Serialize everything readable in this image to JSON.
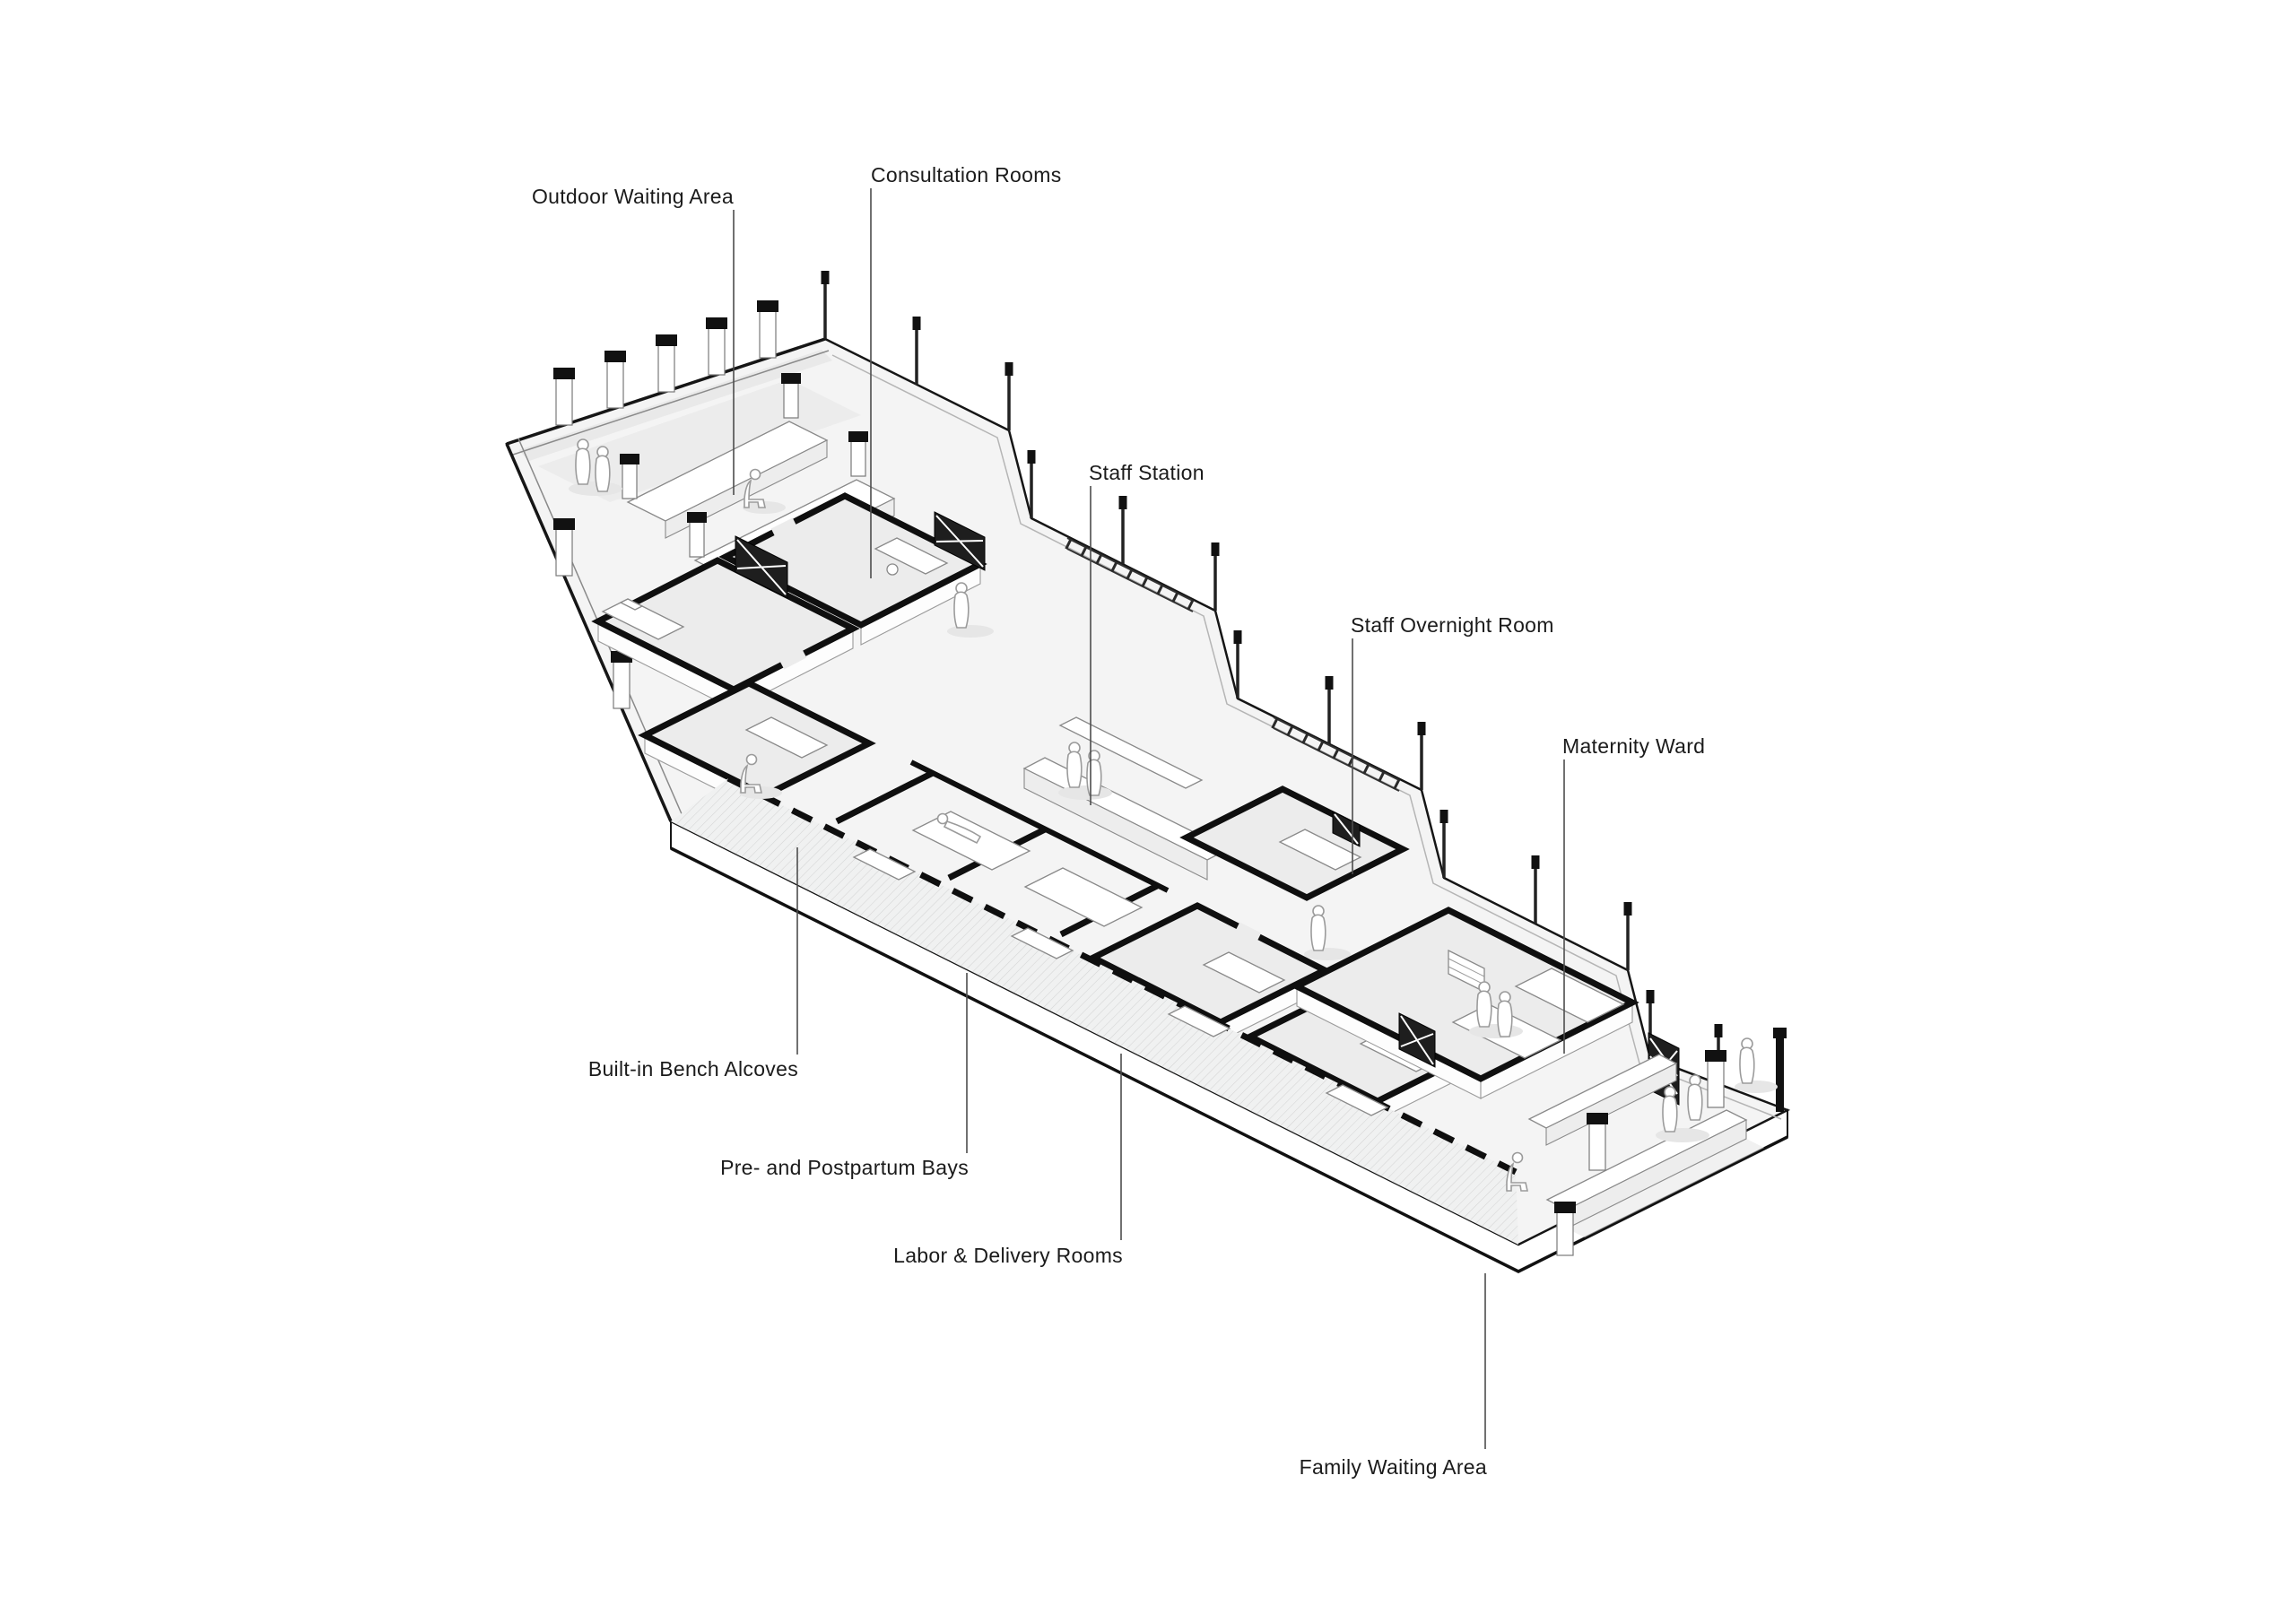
{
  "diagram": {
    "kind": "axonometric architectural floor-plan diagram",
    "annotations": [
      {
        "id": "outdoor-waiting-area",
        "label": "Outdoor Waiting Area"
      },
      {
        "id": "consultation-rooms",
        "label": "Consultation Rooms"
      },
      {
        "id": "staff-station",
        "label": "Staff Station"
      },
      {
        "id": "staff-overnight-room",
        "label": "Staff Overnight Room"
      },
      {
        "id": "maternity-ward",
        "label": "Maternity Ward"
      },
      {
        "id": "built-in-bench-alcoves",
        "label": "Built-in Bench Alcoves"
      },
      {
        "id": "pre-and-postpartum-bays",
        "label": "Pre- and Postpartum Bays"
      },
      {
        "id": "labor-delivery-rooms",
        "label": "Labor & Delivery Rooms"
      },
      {
        "id": "family-waiting-area",
        "label": "Family Waiting Area"
      }
    ],
    "palette": {
      "background": "#ffffff",
      "line": "#1a1a1a",
      "wall_cut": "#0f0f0f",
      "slab_floor": "#f4f4f4",
      "room_floor": "#ececec",
      "shadow": "#e6e6e6",
      "leader_line": "#4d4d4d",
      "label_text": "#1b1b1b"
    }
  }
}
